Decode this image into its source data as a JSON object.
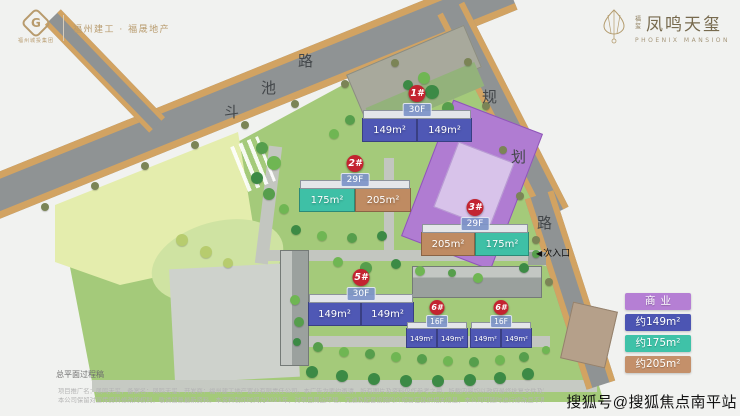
{
  "header": {
    "left_logo": {
      "mark": "G",
      "group_name": "福州城投集团",
      "partner_text": "福州建工 · 福晟地产"
    },
    "right_logo": {
      "prefix": "福玺",
      "title": "凤鸣天玺",
      "subtitle": "PHOENIX MANSION"
    }
  },
  "map": {
    "roads": [
      {
        "name": "斗池路",
        "chars": [
          {
            "t": "斗",
            "x": 224,
            "y": 101
          },
          {
            "t": "池",
            "x": 261,
            "y": 77
          },
          {
            "t": "路",
            "x": 298,
            "y": 50
          }
        ]
      },
      {
        "name": "规划路",
        "chars": [
          {
            "t": "规",
            "x": 482,
            "y": 86
          },
          {
            "t": "划",
            "x": 511,
            "y": 146
          },
          {
            "t": "路",
            "x": 537,
            "y": 212
          }
        ]
      }
    ],
    "entrance": {
      "arrow": "◀",
      "label": "次入口"
    },
    "unit_colors": {
      "t149": "#4f58b5",
      "t175": "#3ec0a6",
      "t205": "#bf8b62"
    },
    "tree_palette": [
      "#569e4c",
      "#6fb653",
      "#3c8a45",
      "#86c05e",
      "#b7cc6e",
      "#7b8456"
    ],
    "buildings": [
      {
        "badge": "1#",
        "floors": "30F",
        "x": 362,
        "y": 118,
        "unit_w": 55,
        "small": false,
        "units": [
          {
            "area": "149m²",
            "type": "t149"
          },
          {
            "area": "149m²",
            "type": "t149"
          }
        ]
      },
      {
        "badge": "2#",
        "floors": "29F",
        "x": 299,
        "y": 188,
        "unit_w": 56,
        "small": false,
        "units": [
          {
            "area": "175m²",
            "type": "t175"
          },
          {
            "area": "205m²",
            "type": "t205"
          }
        ]
      },
      {
        "badge": "3#",
        "floors": "29F",
        "x": 421,
        "y": 232,
        "unit_w": 54,
        "small": false,
        "units": [
          {
            "area": "205m²",
            "type": "t205"
          },
          {
            "area": "175m²",
            "type": "t175"
          }
        ]
      },
      {
        "badge": "5#",
        "floors": "30F",
        "x": 308,
        "y": 302,
        "unit_w": 53,
        "small": false,
        "units": [
          {
            "area": "149m²",
            "type": "t149"
          },
          {
            "area": "149m²",
            "type": "t149"
          }
        ]
      },
      {
        "badge": "6#",
        "floors": "16F",
        "x": 406,
        "y": 328,
        "unit_w": 31,
        "small": true,
        "units": [
          {
            "area": "149m²",
            "type": "t149"
          },
          {
            "area": "149m²",
            "type": "t149"
          }
        ]
      },
      {
        "badge": "6#",
        "floors": "16F",
        "x": 470,
        "y": 328,
        "unit_w": 31,
        "small": true,
        "units": [
          {
            "area": "149m²",
            "type": "t149"
          },
          {
            "area": "149m²",
            "type": "t149"
          }
        ]
      }
    ],
    "trees": [
      [
        45,
        207,
        4,
        5
      ],
      [
        95,
        186,
        4,
        5
      ],
      [
        145,
        166,
        4,
        5
      ],
      [
        195,
        145,
        4,
        5
      ],
      [
        245,
        125,
        4,
        5
      ],
      [
        295,
        104,
        4,
        5
      ],
      [
        345,
        84,
        4,
        5
      ],
      [
        395,
        63,
        4,
        5
      ],
      [
        468,
        62,
        4,
        5
      ],
      [
        486,
        106,
        4,
        5
      ],
      [
        503,
        150,
        4,
        5
      ],
      [
        520,
        196,
        4,
        5
      ],
      [
        536,
        240,
        4,
        5
      ],
      [
        549,
        282,
        4,
        5
      ],
      [
        262,
        148,
        6,
        0
      ],
      [
        274,
        163,
        7,
        1
      ],
      [
        257,
        178,
        6,
        2
      ],
      [
        269,
        194,
        6,
        0
      ],
      [
        284,
        209,
        5,
        1
      ],
      [
        296,
        230,
        5,
        2
      ],
      [
        322,
        236,
        5,
        1
      ],
      [
        352,
        238,
        5,
        0
      ],
      [
        382,
        236,
        5,
        2
      ],
      [
        338,
        262,
        5,
        1
      ],
      [
        366,
        268,
        6,
        0
      ],
      [
        396,
        264,
        5,
        2
      ],
      [
        420,
        271,
        5,
        1
      ],
      [
        432,
        92,
        7,
        2
      ],
      [
        448,
        108,
        6,
        0
      ],
      [
        424,
        78,
        6,
        1
      ],
      [
        408,
        85,
        5,
        2
      ],
      [
        350,
        120,
        5,
        0
      ],
      [
        334,
        134,
        5,
        1
      ],
      [
        452,
        273,
        4,
        0
      ],
      [
        478,
        278,
        5,
        1
      ],
      [
        524,
        268,
        5,
        2
      ],
      [
        536,
        254,
        4,
        0
      ],
      [
        295,
        300,
        5,
        1
      ],
      [
        299,
        322,
        5,
        0
      ],
      [
        297,
        342,
        4,
        2
      ],
      [
        318,
        347,
        5,
        0
      ],
      [
        344,
        352,
        5,
        1
      ],
      [
        370,
        354,
        5,
        0
      ],
      [
        396,
        357,
        5,
        1
      ],
      [
        422,
        359,
        5,
        0
      ],
      [
        448,
        361,
        5,
        1
      ],
      [
        474,
        362,
        5,
        0
      ],
      [
        500,
        360,
        5,
        1
      ],
      [
        524,
        357,
        5,
        0
      ],
      [
        546,
        350,
        4,
        1
      ],
      [
        312,
        372,
        6,
        2
      ],
      [
        342,
        376,
        6,
        2
      ],
      [
        374,
        379,
        6,
        2
      ],
      [
        406,
        381,
        6,
        2
      ],
      [
        438,
        381,
        6,
        2
      ],
      [
        470,
        380,
        6,
        2
      ],
      [
        500,
        378,
        6,
        2
      ],
      [
        528,
        374,
        6,
        2
      ],
      [
        182,
        240,
        6,
        4
      ],
      [
        206,
        252,
        6,
        4
      ],
      [
        228,
        263,
        5,
        4
      ]
    ]
  },
  "legend": {
    "items": [
      {
        "label": "商业",
        "color": "#b57fd4"
      },
      {
        "label": "约149m²",
        "color": "#4c55b3"
      },
      {
        "label": "约175m²",
        "color": "#3fc2a8"
      },
      {
        "label": "约205m²",
        "color": "#c4906a"
      }
    ]
  },
  "footer": {
    "caption": "总平面过程稿",
    "disclaimer_line1": "项目推广名：凤鸣天玺，备案名：凤鸣天玺，开发商：福州建工地产置业有限责任公司。本广告为要约邀请，所有图片及资料仅作参考之用，所载内容均以政府最终批复文件及双方签订的商品房买卖合同约定为准。",
    "disclaimer_line2": "本公司保留对宣传资料修改的权利，敬请留意最新资料。本资料制作时间为2021年，对项目周边环境、交通及配套设施的介绍旨在提供相关信息，本公司可随时进行修改且不再另行通知。",
    "watermark": "搜狐号@搜狐焦点南平站"
  }
}
